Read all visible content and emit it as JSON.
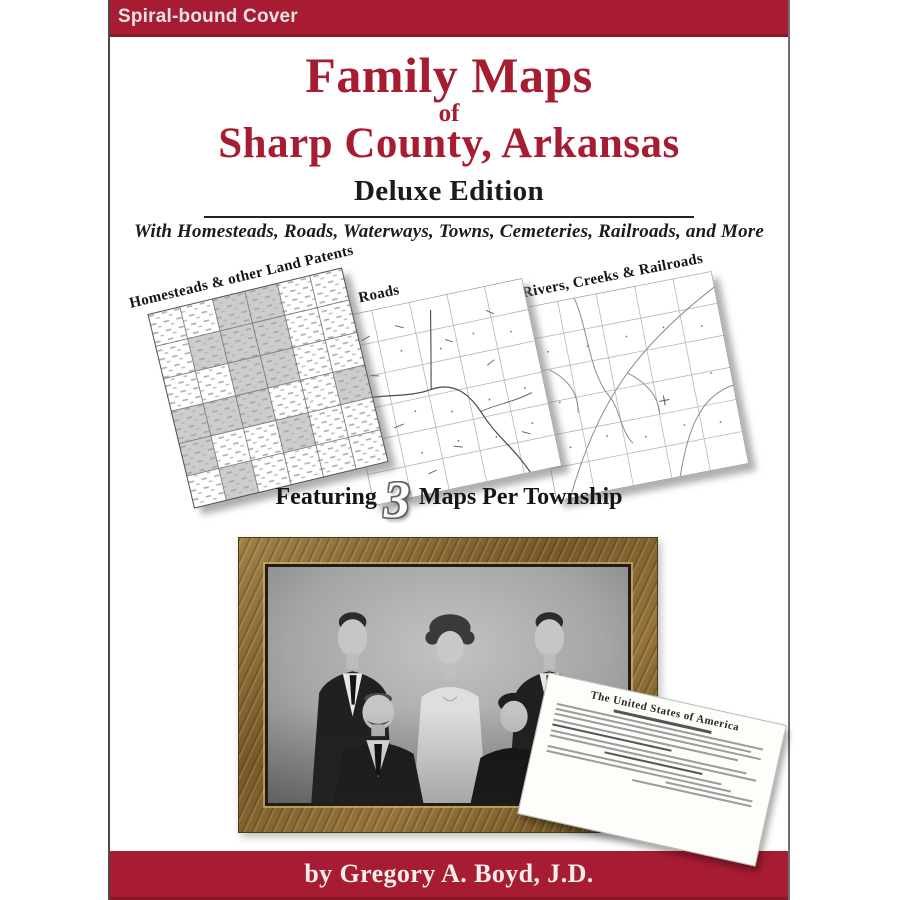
{
  "cover": {
    "binding_label": "Spiral-bound Cover",
    "title_line1": "Family Maps",
    "title_connector": "of",
    "title_line2": "Sharp County, Arkansas",
    "edition": "Deluxe Edition",
    "tagline": "With Homesteads, Roads, Waterways, Towns, Cemeteries, Railroads, and More",
    "byline": "by Gregory A. Boyd, J.D."
  },
  "map_previews": [
    {
      "label": "Homesteads & other Land Patents"
    },
    {
      "label": "Roads"
    },
    {
      "label": "Rivers, Creeks & Railroads"
    }
  ],
  "featuring": {
    "prefix": "Featuring",
    "count": "3",
    "suffix": "Maps Per Township"
  },
  "patent_document": {
    "heading": "The United States of America"
  },
  "colors": {
    "brand_crimson": "#A81C33",
    "brand_crimson_dark": "#8E1628",
    "title_crimson": "#A61D31"
  }
}
